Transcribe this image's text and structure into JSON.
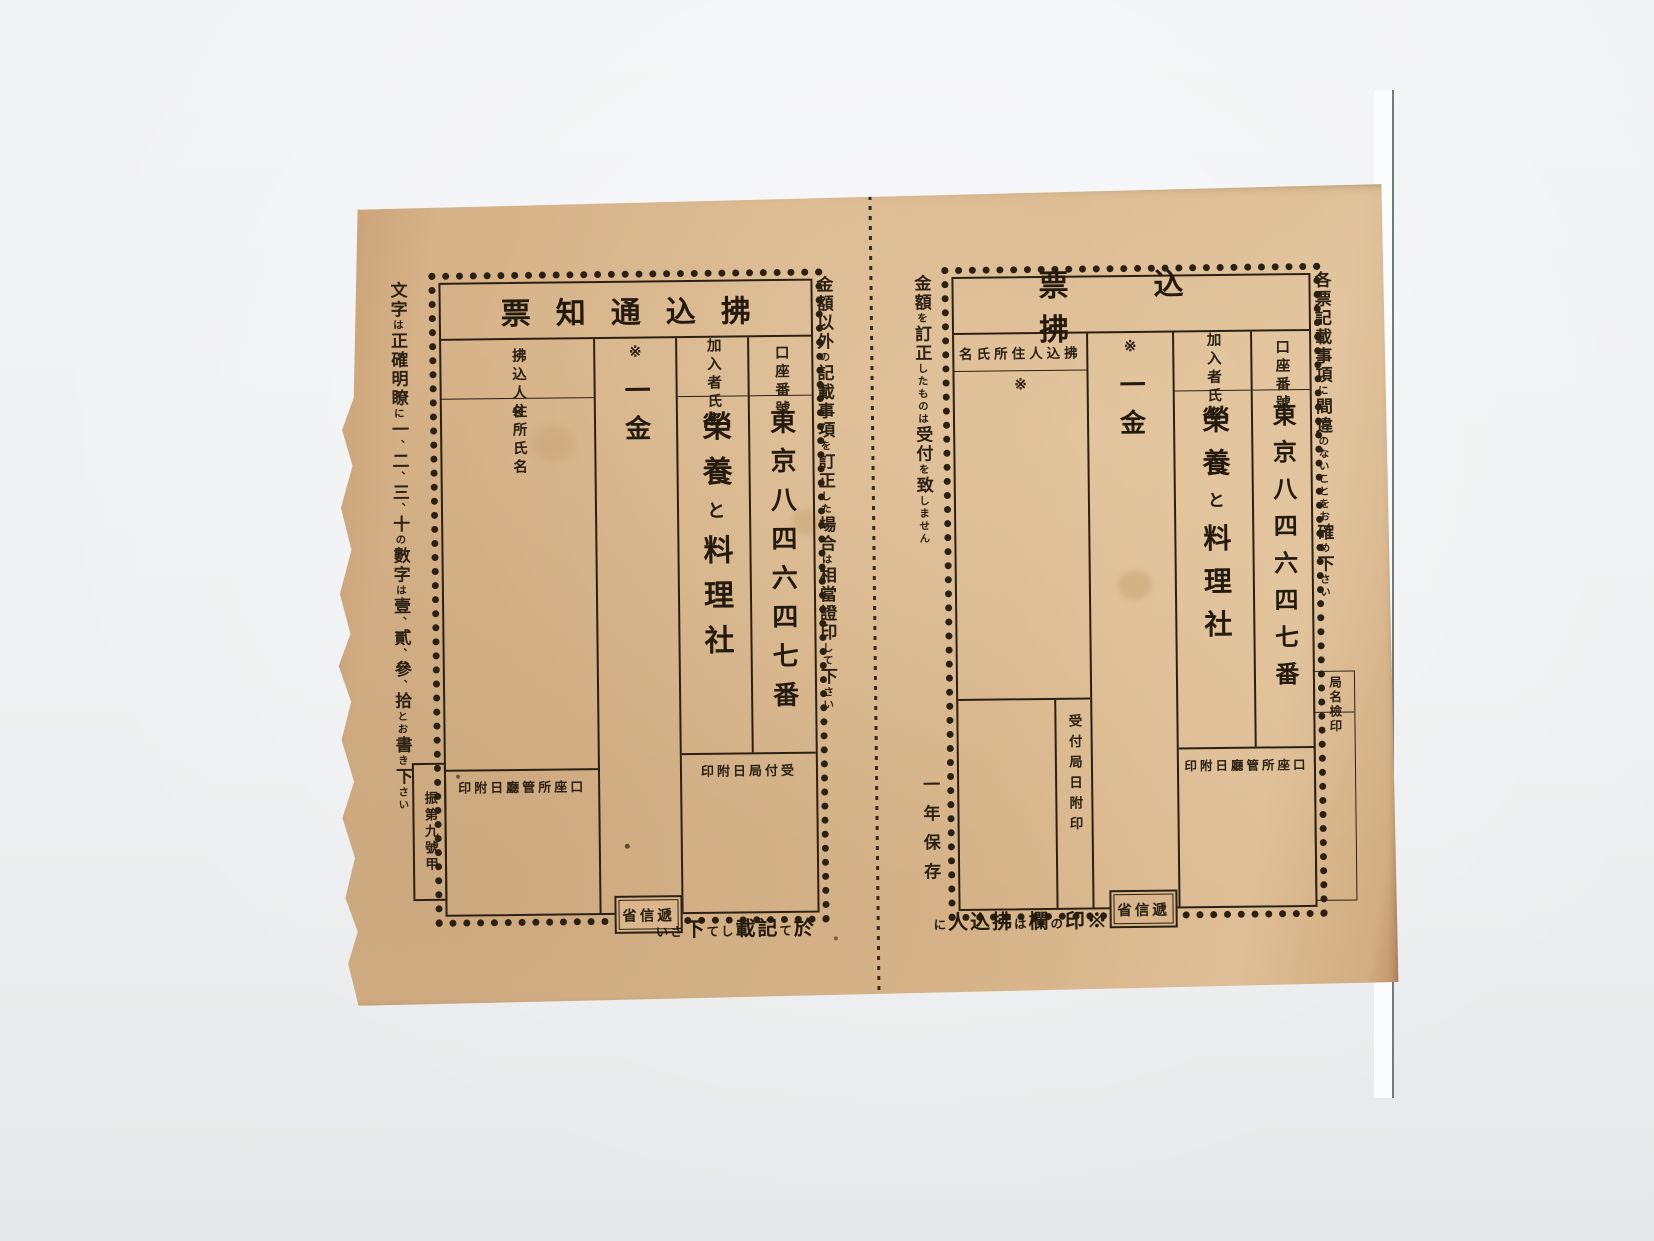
{
  "colors": {
    "paper": "#d9b68c",
    "ink": "#2b2113",
    "background": "#eef0f1",
    "white_sheet": "#fbfcfd"
  },
  "shared": {
    "account_number_label": "口座番號",
    "account_number_value": "東京八四六四七番",
    "subscriber_label": "加入者氏名",
    "subscriber_value": "榮養と料理社",
    "amount_marker": "※",
    "amount_label": "一金",
    "payer_label": "拂込人住所氏名",
    "payer_marker": "※",
    "account_office_stamp_label": "口座所管廳日附印",
    "receiving_office_stamp_label": "受付局日附印",
    "ministry_stamp_label": "遞信省"
  },
  "left_slip": {
    "title": "拂込通知票",
    "left_margin_note": "文字は正確明瞭に一、二、三、十の數字は壹、貳、參、拾とお書き下さい",
    "right_margin_note": "金額以外の記載事項を訂正した場合は相當證印して下さい",
    "form_code": "振第九號甲",
    "bottom_caption": "於て記載して下さい"
  },
  "right_slip": {
    "title": "拂込票",
    "left_margin_note": "金額を訂正したものは受付を致しません",
    "right_margin_note": "各票記載事項に間違のないことをお確め下さい",
    "retention_note": "一年保存",
    "office_name_label": "局名",
    "office_check_label": "檢印",
    "bottom_caption": "※印の欄は拂込人に"
  }
}
